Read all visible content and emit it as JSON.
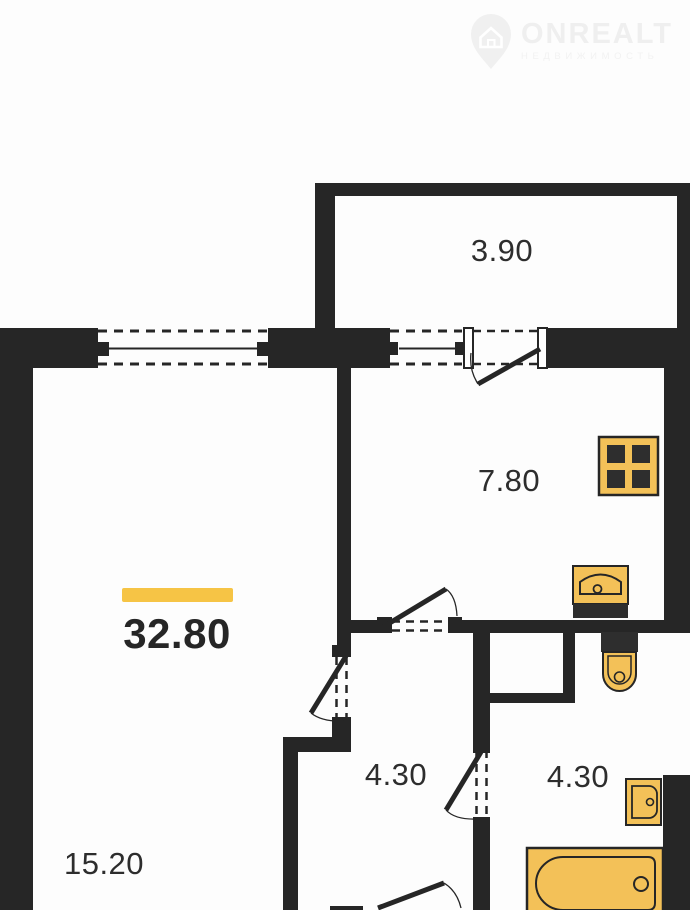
{
  "watermark": {
    "brand": "ONREALT",
    "subtitle": "НЕДВИЖИМОСТЬ"
  },
  "plan": {
    "colors": {
      "wall": "#262626",
      "fixture_fill": "#F3C158",
      "fixture_dark": "#2e2e2e",
      "accent_bar": "#F6C445",
      "label": "#2d2d2d",
      "white": "#ffffff"
    },
    "total": {
      "area": "32.80",
      "cx": 177,
      "cy": 634,
      "bar": [
        122,
        588,
        111,
        14
      ]
    },
    "rooms": [
      {
        "id": "balcony",
        "area": "3.90",
        "cx": 502,
        "cy": 251
      },
      {
        "id": "kitchen",
        "area": "7.80",
        "cx": 509,
        "cy": 481
      },
      {
        "id": "hallway",
        "area": "4.30",
        "cx": 396,
        "cy": 775
      },
      {
        "id": "bathroom",
        "area": "4.30",
        "cx": 578,
        "cy": 777
      },
      {
        "id": "living-room",
        "area": "15.20",
        "cx": 104,
        "cy": 864
      }
    ],
    "walls": [
      [
        315,
        183,
        375,
        13
      ],
      [
        315,
        183,
        20,
        145
      ],
      [
        677,
        196,
        13,
        132
      ],
      [
        0,
        328,
        98,
        40
      ],
      [
        268,
        328,
        122,
        40
      ],
      [
        547,
        328,
        143,
        40
      ],
      [
        0,
        328,
        33,
        582
      ],
      [
        664,
        362,
        26,
        271
      ],
      [
        337,
        367,
        14,
        278
      ],
      [
        332,
        645,
        19,
        12
      ],
      [
        332,
        717,
        19,
        20
      ],
      [
        283,
        737,
        68,
        15
      ],
      [
        283,
        752,
        15,
        158
      ],
      [
        351,
        620,
        26,
        13
      ],
      [
        377,
        617,
        15,
        16
      ],
      [
        448,
        617,
        14,
        16
      ],
      [
        462,
        620,
        202,
        13
      ],
      [
        473,
        632,
        17,
        110
      ],
      [
        473,
        828,
        17,
        82
      ],
      [
        488,
        693,
        87,
        10
      ],
      [
        563,
        632,
        12,
        61
      ],
      [
        663,
        775,
        27,
        135
      ],
      [
        330,
        906,
        33,
        4
      ]
    ],
    "windows": [
      {
        "name": "window-living-room",
        "dash": [
          [
            98,
            331,
            268,
            331
          ],
          [
            98,
            364,
            268,
            364
          ]
        ],
        "line": [
          109,
          348.5,
          259,
          348.5
        ],
        "caps": [
          [
            95,
            342,
            14,
            14
          ],
          [
            257,
            342,
            14,
            14
          ]
        ]
      },
      {
        "name": "window-kitchen",
        "dash": [
          [
            390,
            331,
            462,
            331
          ],
          [
            390,
            364,
            462,
            364
          ]
        ],
        "line": [
          399,
          348.5,
          458,
          348.5
        ],
        "caps": [
          [
            385,
            342,
            13,
            13
          ],
          [
            455,
            342,
            13,
            13
          ]
        ]
      }
    ],
    "doors": [
      {
        "name": "balcony-door",
        "dash": [
          [
            473,
            331,
            538,
            331
          ],
          [
            473,
            364,
            538,
            364
          ]
        ],
        "posts": [
          [
            464,
            328,
            9,
            40
          ],
          [
            538,
            328,
            9,
            40
          ]
        ],
        "jambs": [],
        "leaf": [
          478,
          384,
          540,
          349
        ],
        "arc": "M478,384 Q469,370 471,353"
      },
      {
        "name": "kitchen-door",
        "dash": [
          [
            392,
            621.5,
            448,
            621.5
          ],
          [
            392,
            630.5,
            448,
            630.5
          ]
        ],
        "posts": [],
        "jambs": [],
        "leaf": [
          383,
          627,
          446,
          589
        ],
        "arc": "M446,589 Q456,596 457,616"
      },
      {
        "name": "living-room-door",
        "dash": [
          [
            336.5,
            657,
            336.5,
            717
          ],
          [
            346.5,
            657,
            346.5,
            717
          ]
        ],
        "posts": [],
        "jambs": [],
        "leaf": [
          346,
          656,
          311,
          713
        ],
        "arc": "M311,713 Q322,722 344,721"
      },
      {
        "name": "bathroom-door",
        "dash": [
          [
            476.5,
            750,
            476.5,
            817
          ],
          [
            486.5,
            750,
            486.5,
            817
          ]
        ],
        "posts": [],
        "jambs": [
          [
            473,
            742,
            17,
            11
          ],
          [
            473,
            817,
            17,
            11
          ]
        ],
        "leaf": [
          481,
          752,
          446,
          810
        ],
        "arc": "M446,810 Q455,820 478,819"
      },
      {
        "name": "entrance-door",
        "dash": [],
        "posts": [],
        "jambs": [],
        "leaf": [
          378,
          908,
          444,
          883
        ],
        "arc": "M444,883 Q457,891 461,908"
      }
    ],
    "fixtures": [
      {
        "type": "stove",
        "name": "stove",
        "x": 599,
        "y": 437,
        "w": 59,
        "h": 58
      },
      {
        "type": "sink",
        "name": "kitchen-sink",
        "x": 573,
        "y": 566,
        "w": 55,
        "h": 52
      },
      {
        "type": "toilet",
        "name": "toilet",
        "x": 601,
        "y": 632,
        "w": 37,
        "h": 60
      },
      {
        "type": "washbasin",
        "name": "washbasin",
        "x": 626,
        "y": 779,
        "w": 35,
        "h": 46
      },
      {
        "type": "bathtub",
        "name": "bathtub",
        "x": 527,
        "y": 848,
        "w": 136,
        "h": 62
      }
    ]
  }
}
